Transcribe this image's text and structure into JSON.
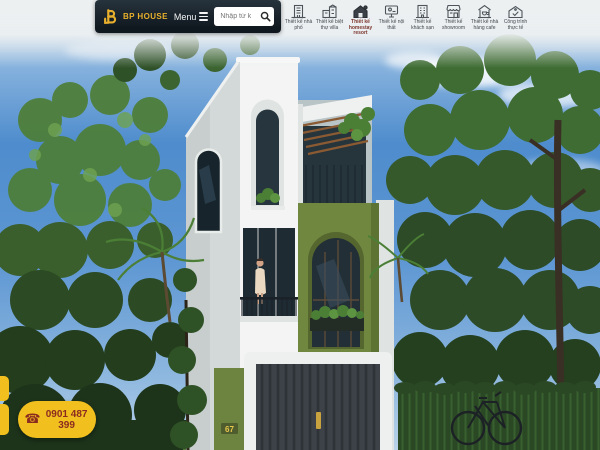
{
  "header": {
    "brand": {
      "name": "BP HOUSE"
    },
    "menu_label": "Menu",
    "search": {
      "placeholder": "Nhập từ k"
    },
    "nav_items": [
      {
        "label": "Thiết kế nhà phố",
        "icon": "townhouse-icon",
        "active": false
      },
      {
        "label": "Thiết kế biệt thự villa",
        "icon": "villa-icon",
        "active": false
      },
      {
        "label": "Thiết kế homestay resort",
        "icon": "homestay-icon",
        "active": true
      },
      {
        "label": "Thiết kế nội thất",
        "icon": "interior-design-icon",
        "active": false
      },
      {
        "label": "Thiết kế khách sạn",
        "icon": "hotel-icon",
        "active": false
      },
      {
        "label": "Thiết kế showroom",
        "icon": "showroom-icon",
        "active": false
      },
      {
        "label": "Thiết kế nhà hàng cafe",
        "icon": "restaurant-cafe-icon",
        "active": false
      },
      {
        "label": "Công trình thực tế",
        "icon": "completed-project-icon",
        "active": false
      }
    ]
  },
  "hero": {
    "house_number": "67"
  },
  "contact": {
    "phone": "0901 487 399"
  },
  "colors": {
    "accent_yellow": "#f2c01e",
    "logo_gold": "#e8b02c",
    "header_dark": "#141f28",
    "phone_text": "#8b2b20",
    "olive_wall": "#70873f",
    "sky_blue": "#4e8ccd"
  }
}
